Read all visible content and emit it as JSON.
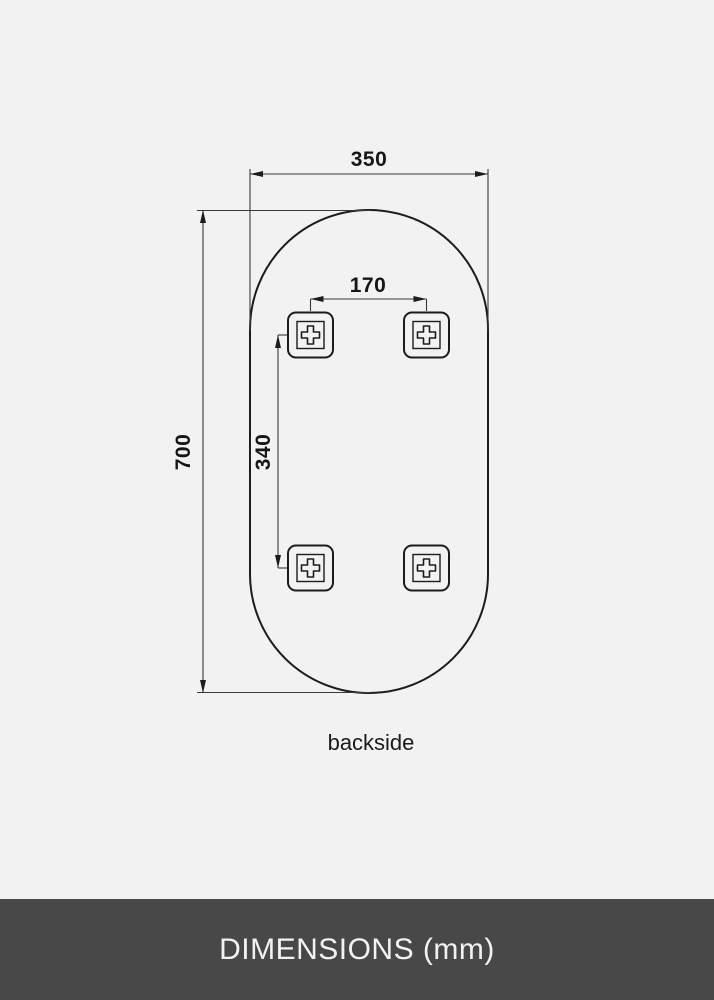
{
  "diagram": {
    "caption": "backside",
    "dimensions": {
      "width_mm": "350",
      "height_mm": "700",
      "bracket_spacing_horizontal_mm": "170",
      "bracket_spacing_vertical_mm": "340"
    },
    "bracket_count": 4,
    "shape": "pill-oval-mirror-outline"
  },
  "footer": {
    "title": "DIMENSIONS (mm)"
  },
  "colors": {
    "background": "#f2f2f2",
    "line": "#1c1c1c",
    "thin_line": "#3a3a3a",
    "footer_background": "#484848",
    "footer_text": "#f2f2f2"
  }
}
